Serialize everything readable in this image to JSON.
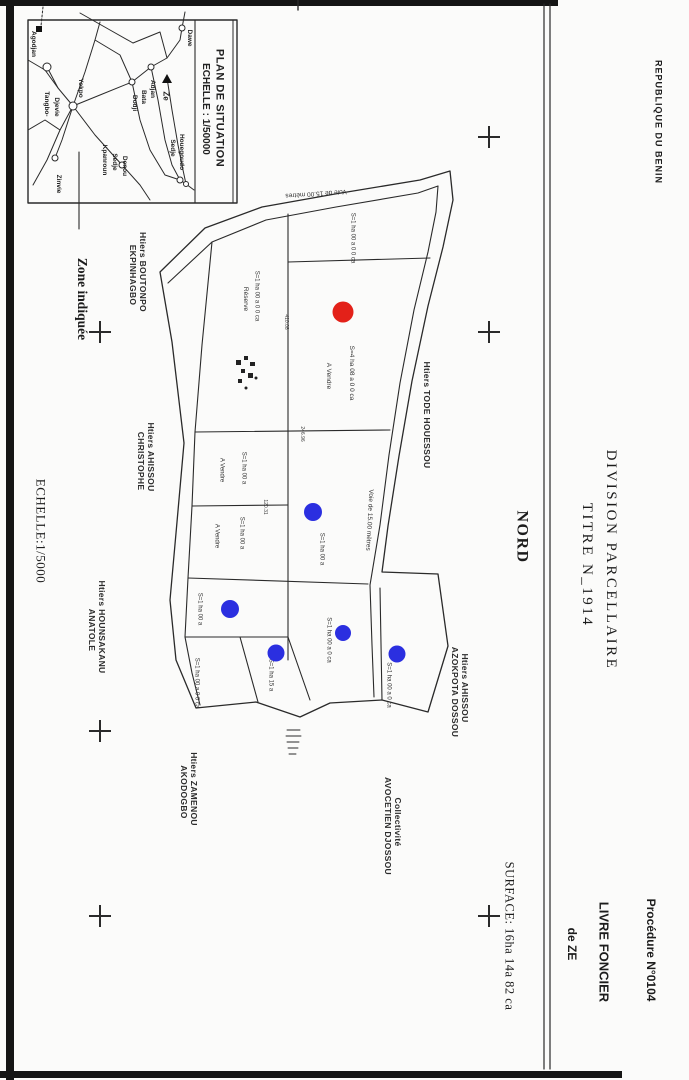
{
  "page": {
    "width": 689,
    "height": 1080,
    "background": "#fbfbfa"
  },
  "colors": {
    "ink": "#1c1c1c",
    "line": "#2a2a2a",
    "red_marker": "#e32119",
    "blue_marker": "#2b2fe0"
  },
  "margin": {
    "country": {
      "name": "country-label",
      "text": "REPUBLIQUE DU BENIN",
      "x": 658,
      "y": 122,
      "cls": "c-head",
      "fs": 9,
      "ls": 1
    },
    "procedure": {
      "name": "procedure-label",
      "text": "Procédure N°0104",
      "x": 651,
      "y": 950,
      "cls": "c-head",
      "fs": 12
    },
    "title1": {
      "name": "doc-title-line1",
      "text": "DIVISION PARCELLAIRE",
      "x": 610,
      "y": 560,
      "cls": "c-title",
      "fs": 15
    },
    "title2": {
      "name": "doc-title-line2",
      "text": "TITRE N_1914",
      "x": 586,
      "y": 565,
      "cls": "c-title",
      "fs": 15
    },
    "registry1": {
      "name": "registry-line1",
      "text": "LIVRE FONCIER",
      "x": 604,
      "y": 952,
      "cls": "c-head",
      "fs": 13
    },
    "registry2": {
      "name": "registry-line2",
      "text": "de ZE",
      "x": 572,
      "y": 944,
      "cls": "c-head",
      "fs": 12
    }
  },
  "plan": {
    "north": {
      "name": "north-label",
      "text": "NORD",
      "x": 521,
      "y": 537,
      "cls": "c-serifb",
      "fs": 16,
      "ls": 1.5
    },
    "surface": {
      "name": "surface-label",
      "text": "SURFACE: 16ha 14a 82 ca",
      "x": 509,
      "y": 936,
      "cls": "c-serif",
      "fs": 12.5,
      "ls": 0.5
    },
    "scale": {
      "name": "main-scale-label",
      "text": "ECHELLE:1/5000",
      "x": 41,
      "y": 531,
      "cls": "c-serif",
      "fs": 13,
      "ls": 0.5
    },
    "zone": {
      "name": "zone-note-label",
      "text": "Zone indiquée",
      "x": 82,
      "y": 299,
      "cls": "c-serifb",
      "fs": 13.5
    },
    "owners": [
      {
        "name": "owner-label",
        "text": "Htiers BOUTONPO",
        "x": 143,
        "y": 272,
        "cls": "c-owner",
        "fs": 8.5
      },
      {
        "name": "owner-label",
        "text": "EKPINHAGBO",
        "x": 133,
        "y": 275,
        "cls": "c-owner",
        "fs": 8.5
      },
      {
        "name": "owner-label",
        "text": "Htiers AHISSOU",
        "x": 151,
        "y": 457,
        "cls": "c-owner",
        "fs": 8.5
      },
      {
        "name": "owner-label",
        "text": "CHRISTOPHE",
        "x": 141,
        "y": 461,
        "cls": "c-owner",
        "fs": 8.5
      },
      {
        "name": "owner-label",
        "text": "Htiers HOUNSAKANU",
        "x": 102,
        "y": 627,
        "cls": "c-owner",
        "fs": 8.5
      },
      {
        "name": "owner-label",
        "text": "ANATOLE",
        "x": 92,
        "y": 630,
        "cls": "c-owner",
        "fs": 8.5
      },
      {
        "name": "owner-label",
        "text": "Htiers ZAMENOU",
        "x": 194,
        "y": 789,
        "cls": "c-owner",
        "fs": 8.5
      },
      {
        "name": "owner-label",
        "text": "AKODOGBO",
        "x": 184,
        "y": 792,
        "cls": "c-owner",
        "fs": 8.5
      },
      {
        "name": "owner-label",
        "text": "Collectivité",
        "x": 398,
        "y": 822,
        "cls": "c-owner",
        "fs": 8.5
      },
      {
        "name": "owner-label",
        "text": "AVOCETIEN DJOSSOU",
        "x": 388,
        "y": 826,
        "cls": "c-owner",
        "fs": 8.5
      },
      {
        "name": "owner-label",
        "text": "Htiers AHISSOU",
        "x": 465,
        "y": 688,
        "cls": "c-owner",
        "fs": 8.5
      },
      {
        "name": "owner-label",
        "text": "AZOKPOTA DOSSOU",
        "x": 455,
        "y": 692,
        "cls": "c-owner",
        "fs": 8.5
      },
      {
        "name": "owner-label",
        "text": "Htiers TODE HOUESSOU",
        "x": 427,
        "y": 415,
        "cls": "c-owner",
        "fs": 8.5
      }
    ],
    "parcel_labels": [
      {
        "name": "parcel-label",
        "text": "S=1 ha 00 a 0 0 ca",
        "x": 352,
        "y": 238,
        "cls": "c-parcel",
        "fs": 6
      },
      {
        "name": "parcel-label",
        "text": "S=4 ha 08 a 0 0 ca",
        "x": 351,
        "y": 373,
        "cls": "c-parcel",
        "fs": 6.5
      },
      {
        "name": "parcel-label",
        "text": "A Vendre",
        "x": 328,
        "y": 376,
        "cls": "c-parcel",
        "fs": 6.5
      },
      {
        "name": "parcel-label",
        "text": "S=1 ha 00 a 0 0 ca",
        "x": 256,
        "y": 296,
        "cls": "c-parcel",
        "fs": 6
      },
      {
        "name": "parcel-label",
        "text": "Réserve",
        "x": 245,
        "y": 299,
        "cls": "c-parcel",
        "fs": 6.5
      },
      {
        "name": "parcel-label",
        "text": "S=1 ha 00 a",
        "x": 243,
        "y": 468,
        "cls": "c-parcel",
        "fs": 6
      },
      {
        "name": "parcel-label",
        "text": "A Vendre",
        "x": 221,
        "y": 470,
        "cls": "c-parcel",
        "fs": 6
      },
      {
        "name": "parcel-label",
        "text": "S=1 ha 00 a",
        "x": 241,
        "y": 533,
        "cls": "c-parcel",
        "fs": 6
      },
      {
        "name": "parcel-label",
        "text": "A Vendre",
        "x": 216,
        "y": 536,
        "cls": "c-parcel",
        "fs": 6
      },
      {
        "name": "parcel-label",
        "text": "S=1 ha 00 a",
        "x": 321,
        "y": 549,
        "cls": "c-parcel",
        "fs": 6
      },
      {
        "name": "parcel-label",
        "text": "S=1 ha 00 a",
        "x": 199,
        "y": 609,
        "cls": "c-parcel",
        "fs": 6
      },
      {
        "name": "parcel-label",
        "text": "S=1 ha 00 a 0 0 ca",
        "x": 196,
        "y": 683,
        "cls": "c-parcel",
        "fs": 6
      },
      {
        "name": "parcel-label",
        "text": "S=1 ha 15 a",
        "x": 270,
        "y": 675,
        "cls": "c-parcel",
        "fs": 6
      },
      {
        "name": "parcel-label",
        "text": "S=1 ha 00 a 0 ca",
        "x": 328,
        "y": 640,
        "cls": "c-parcel",
        "fs": 6
      },
      {
        "name": "parcel-label",
        "text": "S=1 ha 00 a 0 ca",
        "x": 388,
        "y": 685,
        "cls": "c-parcel",
        "fs": 6
      }
    ],
    "road_labels": [
      {
        "name": "road-label",
        "text": "Voie de 15.00 mètres",
        "x": 316,
        "y": 193,
        "rot": 176,
        "cls": "c-road",
        "fs": 6.5
      },
      {
        "name": "road-label",
        "text": "Voie de 15.00 mètres",
        "x": 369,
        "y": 520,
        "rot": 93,
        "cls": "c-road",
        "fs": 6.5
      }
    ],
    "dimensions": [
      {
        "name": "dimension-label",
        "text": "246.96",
        "x": 301,
        "y": 434,
        "cls": "c-dim",
        "fs": 5
      },
      {
        "name": "dimension-label",
        "text": "120.31",
        "x": 264,
        "y": 507,
        "cls": "c-dim",
        "fs": 5
      },
      {
        "name": "dimension-label",
        "text": "410.08",
        "x": 285,
        "y": 322,
        "cls": "c-dim",
        "fs": 5
      }
    ]
  },
  "inset": {
    "title": {
      "name": "inset-title",
      "text": "PLAN DE SITUATION",
      "x": 219,
      "y": 108,
      "cls": "c-place",
      "fs": 11,
      "ls": 0.5
    },
    "scale": {
      "name": "inset-scale",
      "text": "ECHELLE : 1/50000",
      "x": 205,
      "y": 109,
      "cls": "c-place",
      "fs": 10
    },
    "places": [
      {
        "name": "place-label",
        "text": "Agodjan",
        "x": 33,
        "y": 44,
        "cls": "c-place",
        "fs": 6.5
      },
      {
        "name": "place-label",
        "text": "Dawe",
        "x": 189,
        "y": 38,
        "cls": "c-place",
        "fs": 6.5
      },
      {
        "name": "place-label",
        "text": "Ze",
        "x": 166,
        "y": 96,
        "cls": "c-place",
        "fs": 8
      },
      {
        "name": "place-label",
        "text": "Adjan",
        "x": 152,
        "y": 89,
        "cls": "c-place",
        "fs": 6.5
      },
      {
        "name": "place-label",
        "text": "Bata",
        "x": 143,
        "y": 97,
        "cls": "c-place",
        "fs": 6.5
      },
      {
        "name": "place-label",
        "text": "Dodji",
        "x": 134,
        "y": 103,
        "cls": "c-place",
        "fs": 6.5
      },
      {
        "name": "place-label",
        "text": "Sedje",
        "x": 172,
        "y": 148,
        "cls": "c-place",
        "fs": 6.5
      },
      {
        "name": "place-label",
        "text": "Houegoudo",
        "x": 181,
        "y": 152,
        "cls": "c-place",
        "fs": 6.5
      },
      {
        "name": "place-label",
        "text": "Sedje",
        "x": 114,
        "y": 162,
        "cls": "c-place",
        "fs": 6.5
      },
      {
        "name": "place-label",
        "text": "Denou",
        "x": 124,
        "y": 166,
        "cls": "c-place",
        "fs": 6.5
      },
      {
        "name": "place-label",
        "text": "Kpanroun",
        "x": 104,
        "y": 160,
        "cls": "c-place",
        "fs": 6.5
      },
      {
        "name": "place-label",
        "text": "Yokpo",
        "x": 80,
        "y": 88,
        "cls": "c-place",
        "fs": 6.5
      },
      {
        "name": "place-label",
        "text": "Tangbo-",
        "x": 46,
        "y": 104,
        "cls": "c-place",
        "fs": 6.5
      },
      {
        "name": "place-label",
        "text": "Djevie",
        "x": 56,
        "y": 107,
        "cls": "c-place",
        "fs": 6.5
      },
      {
        "name": "place-label",
        "text": "Zinvie",
        "x": 58,
        "y": 184,
        "cls": "c-place",
        "fs": 6.5
      }
    ]
  },
  "markers": [
    {
      "name": "red-parcel-marker",
      "color": "#e32119",
      "x": 343,
      "y": 312,
      "r": 10.5
    },
    {
      "name": "blue-parcel-marker",
      "color": "#2b2fe0",
      "x": 313,
      "y": 512,
      "r": 9
    },
    {
      "name": "blue-parcel-marker",
      "color": "#2b2fe0",
      "x": 230,
      "y": 609,
      "r": 9
    },
    {
      "name": "blue-parcel-marker",
      "color": "#2b2fe0",
      "x": 276,
      "y": 653,
      "r": 8.5
    },
    {
      "name": "blue-parcel-marker",
      "color": "#2b2fe0",
      "x": 343,
      "y": 633,
      "r": 8
    },
    {
      "name": "blue-parcel-marker",
      "color": "#2b2fe0",
      "x": 397,
      "y": 654,
      "r": 8.5
    }
  ],
  "crosses": [
    {
      "x": 100,
      "y": 332
    },
    {
      "x": 100,
      "y": 731
    },
    {
      "x": 100,
      "y": 916
    },
    {
      "x": 489,
      "y": 137
    },
    {
      "x": 489,
      "y": 332
    },
    {
      "x": 489,
      "y": 916
    }
  ]
}
